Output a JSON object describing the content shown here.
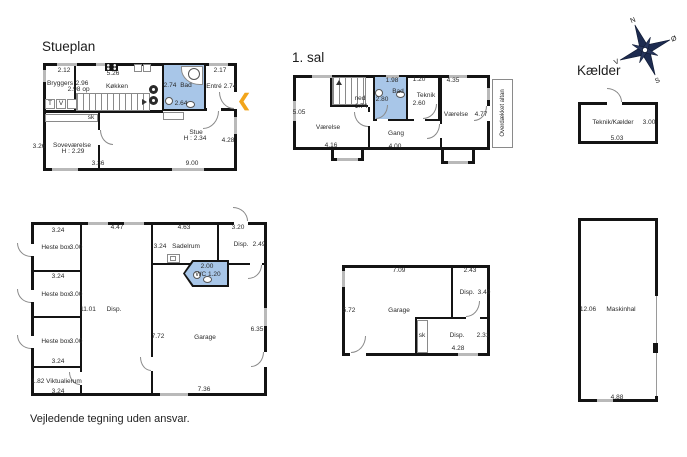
{
  "footer": "Vejledende tegning uden ansvar.",
  "compass": {
    "n": "N",
    "e": "Ø",
    "s": "S",
    "v": "V"
  },
  "stueplan": {
    "title": "Stueplan",
    "labels": {
      "dim_bryggers_top": "2.12",
      "bryggers": "Bryggers",
      "dim_hall": "2.96",
      "dim_bryggers": "2.98",
      "op": "op",
      "t": "T",
      "v": "V",
      "sk": "sk",
      "dim_koekken_top": "5.26",
      "koekken": "Køkken",
      "dim_bad_w": "2.74",
      "bad": "Bad",
      "dim_bad_h": "2.64",
      "dim_entre_top": "2.17",
      "entre": "Entré",
      "dim_entre": "2.74",
      "stue": "Stue",
      "stue_h": "H : 2.34",
      "dim_sove_left": "3.26",
      "sove": "Soveværelse",
      "sove_h": "H : 2.29",
      "dim_sove_bottom": "3.36",
      "dim_stue_bottom": "9.00",
      "dim_stue_right": "4.28"
    }
  },
  "sal1": {
    "title": "1. sal",
    "labels": {
      "ned": "ned",
      "dim_stair": "1.74",
      "dim_left": "5.05",
      "vaerelse_l": "Værelse",
      "dim_vl_bottom": "4.16",
      "dim_bad_top": "1.98",
      "bad": "Bad",
      "dim_bad_left": "2.80",
      "dim_teknik_top": "1.20",
      "teknik": "Teknik",
      "dim_teknik": "2.60",
      "gang": "Gang",
      "dim_gang_bottom": "4.00",
      "dim_vr_top": "4.35",
      "vaerelse_r": "Værelse",
      "dim_vr_right": "4.77",
      "altan": "Overdækket altan"
    }
  },
  "kaelder": {
    "title": "Kælder",
    "labels": {
      "room": "Teknik/Kælder",
      "dim_right": "3.00",
      "dim_bottom": "5.03"
    }
  },
  "stald": {
    "labels": {
      "dim_box1_top": "3.24",
      "box1": "Heste box",
      "box1_d": "3.00",
      "dim_box2_top": "3.24",
      "box2": "Heste box",
      "box2_d": "3.00",
      "box3": "Heste box",
      "box3_d": "3.00",
      "dim_box3_bottom": "3.24",
      "vikt_d": "1.82",
      "vikt": "Viktualierum",
      "dim_vikt_bottom": "3.24",
      "dim_hall": "11.01",
      "disp": "Disp.",
      "dim_hall_top": "4.47",
      "dim_sadel_top": "4.63",
      "dim_sadel_left": "3.24",
      "sadelrum": "Sadelrum",
      "dim_disp2_top": "3.20",
      "disp2": "Disp.",
      "dim_disp2_right": "2.49",
      "wc_d": "2.00",
      "wc": "WC 1.20",
      "dim_garage_left": "7.72",
      "garage": "Garage",
      "dim_garage_right": "6.35",
      "dim_garage_bottom": "7.36"
    }
  },
  "garage2": {
    "labels": {
      "dim_top": "7.09",
      "dim_disp_top": "2.43",
      "disp": "Disp.",
      "dim_disp_right": "3.40",
      "dim_left": "5.72",
      "garage": "Garage",
      "sk": "sk",
      "disp2": "Disp.",
      "dim_disp2_right": "2.31",
      "dim_bottom": "4.28"
    }
  },
  "maskinhal": {
    "labels": {
      "dim_left": "12.06",
      "name": "Maskinhal",
      "dim_bottom": "4.88"
    }
  }
}
